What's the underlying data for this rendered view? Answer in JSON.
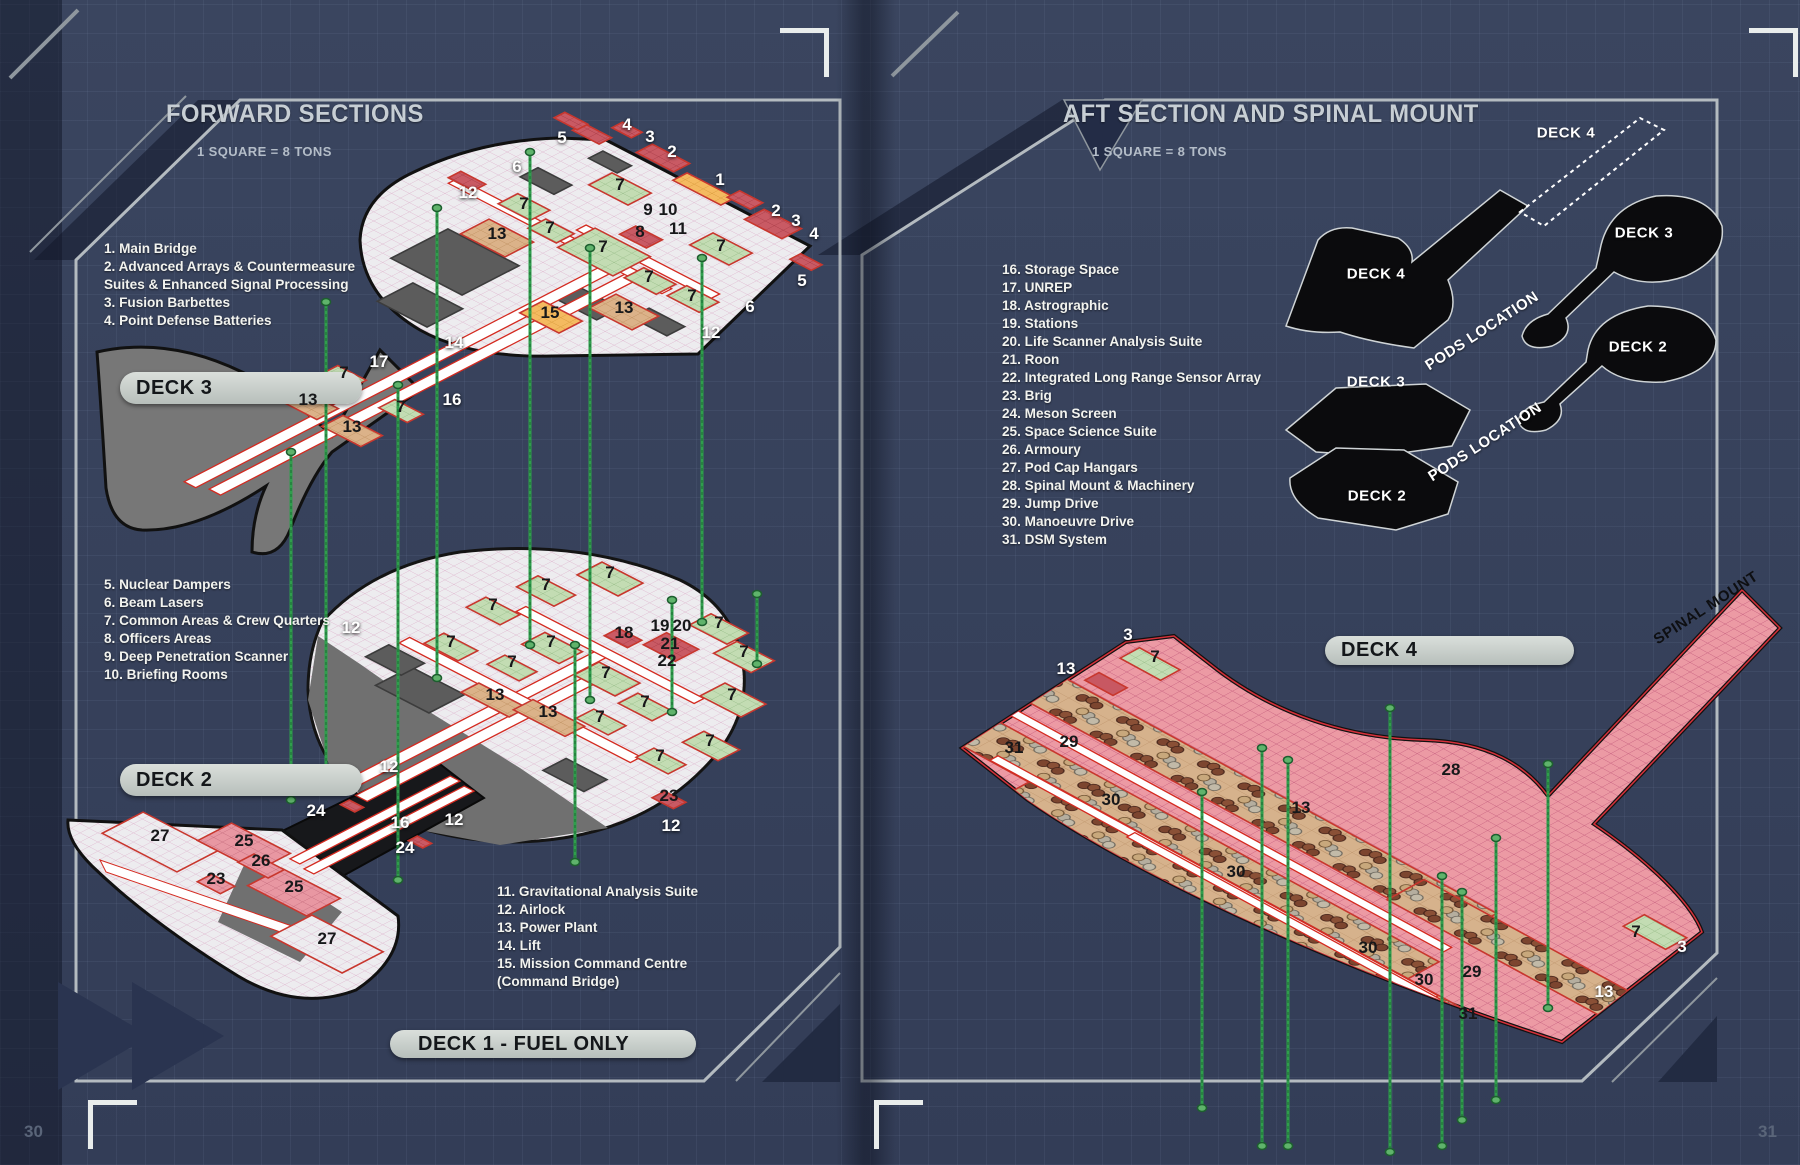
{
  "left_page": {
    "page_number": "30",
    "title": "FORWARD SECTIONS",
    "scale_note": "1 SQUARE = 8 TONS",
    "legend_groups": [
      {
        "items": [
          "1. Main Bridge",
          "2. Advanced Arrays & Countermeasure",
          "Suites & Enhanced Signal Processing",
          "3. Fusion Barbettes",
          "4. Point Defense Batteries"
        ]
      },
      {
        "items": [
          "5. Nuclear Dampers",
          "6. Beam Lasers",
          "7. Common Areas & Crew Quarters",
          "8. Officers Areas",
          "9. Deep Penetration Scanner",
          "10. Briefing Rooms"
        ]
      },
      {
        "items": [
          "11. Gravitational Analysis Suite",
          "12. Airlock",
          "13. Power Plant",
          "14. Lift",
          "15. Mission Command Centre",
          "(Command Bridge)"
        ]
      }
    ],
    "banners": {
      "deck3": "DECK 3",
      "deck2": "DECK 2",
      "deck1": "DECK 1 - FUEL ONLY"
    },
    "callouts": [
      {
        "t": "4",
        "x": 627,
        "y": 125,
        "c": "w"
      },
      {
        "t": "3",
        "x": 650,
        "y": 137,
        "c": "w"
      },
      {
        "t": "2",
        "x": 672,
        "y": 152,
        "c": "w"
      },
      {
        "t": "5",
        "x": 562,
        "y": 138,
        "c": "w"
      },
      {
        "t": "6",
        "x": 517,
        "y": 167,
        "c": "w"
      },
      {
        "t": "12",
        "x": 468,
        "y": 193,
        "c": "w"
      },
      {
        "t": "1",
        "x": 720,
        "y": 180,
        "c": "w"
      },
      {
        "t": "2",
        "x": 776,
        "y": 211,
        "c": "w"
      },
      {
        "t": "3",
        "x": 796,
        "y": 221,
        "c": "w"
      },
      {
        "t": "4",
        "x": 814,
        "y": 234,
        "c": "w"
      },
      {
        "t": "5",
        "x": 802,
        "y": 281,
        "c": "w"
      },
      {
        "t": "6",
        "x": 750,
        "y": 307,
        "c": "w"
      },
      {
        "t": "12",
        "x": 711,
        "y": 333,
        "c": "w"
      },
      {
        "t": "14",
        "x": 454,
        "y": 343,
        "c": "w"
      },
      {
        "t": "17",
        "x": 379,
        "y": 362,
        "c": "w"
      },
      {
        "t": "16",
        "x": 452,
        "y": 400,
        "c": "w"
      },
      {
        "t": "7",
        "x": 620,
        "y": 185,
        "c": "b"
      },
      {
        "t": "9",
        "x": 648,
        "y": 210,
        "c": "b"
      },
      {
        "t": "10",
        "x": 668,
        "y": 210,
        "c": "b"
      },
      {
        "t": "8",
        "x": 640,
        "y": 232,
        "c": "b"
      },
      {
        "t": "11",
        "x": 678,
        "y": 229,
        "c": "b"
      },
      {
        "t": "7",
        "x": 524,
        "y": 204,
        "c": "b"
      },
      {
        "t": "13",
        "x": 497,
        "y": 234,
        "c": "b"
      },
      {
        "t": "7",
        "x": 550,
        "y": 228,
        "c": "b"
      },
      {
        "t": "7",
        "x": 603,
        "y": 247,
        "c": "b"
      },
      {
        "t": "7",
        "x": 721,
        "y": 246,
        "c": "b"
      },
      {
        "t": "7",
        "x": 649,
        "y": 277,
        "c": "b"
      },
      {
        "t": "7",
        "x": 692,
        "y": 296,
        "c": "b"
      },
      {
        "t": "15",
        "x": 550,
        "y": 313,
        "c": "b"
      },
      {
        "t": "13",
        "x": 624,
        "y": 308,
        "c": "b"
      },
      {
        "t": "13",
        "x": 308,
        "y": 400,
        "c": "b"
      },
      {
        "t": "13",
        "x": 352,
        "y": 427,
        "c": "b"
      },
      {
        "t": "7",
        "x": 344,
        "y": 373,
        "c": "b"
      },
      {
        "t": "7",
        "x": 401,
        "y": 407,
        "c": "b"
      },
      {
        "t": "12",
        "x": 351,
        "y": 628,
        "c": "w"
      },
      {
        "t": "12",
        "x": 389,
        "y": 767,
        "c": "w"
      },
      {
        "t": "12",
        "x": 454,
        "y": 820,
        "c": "w"
      },
      {
        "t": "12",
        "x": 671,
        "y": 826,
        "c": "w"
      },
      {
        "t": "16",
        "x": 400,
        "y": 823,
        "c": "w"
      },
      {
        "t": "24",
        "x": 316,
        "y": 811,
        "c": "w"
      },
      {
        "t": "24",
        "x": 405,
        "y": 848,
        "c": "w"
      },
      {
        "t": "7",
        "x": 610,
        "y": 573,
        "c": "b"
      },
      {
        "t": "7",
        "x": 546,
        "y": 585,
        "c": "b"
      },
      {
        "t": "7",
        "x": 493,
        "y": 605,
        "c": "b"
      },
      {
        "t": "7",
        "x": 451,
        "y": 642,
        "c": "b"
      },
      {
        "t": "7",
        "x": 551,
        "y": 642,
        "c": "b"
      },
      {
        "t": "18",
        "x": 624,
        "y": 633,
        "c": "b"
      },
      {
        "t": "19",
        "x": 660,
        "y": 626,
        "c": "b"
      },
      {
        "t": "20",
        "x": 682,
        "y": 626,
        "c": "b"
      },
      {
        "t": "21",
        "x": 670,
        "y": 644,
        "c": "b"
      },
      {
        "t": "22",
        "x": 667,
        "y": 661,
        "c": "b"
      },
      {
        "t": "7",
        "x": 719,
        "y": 623,
        "c": "b"
      },
      {
        "t": "7",
        "x": 744,
        "y": 652,
        "c": "b"
      },
      {
        "t": "7",
        "x": 512,
        "y": 662,
        "c": "b"
      },
      {
        "t": "7",
        "x": 606,
        "y": 673,
        "c": "b"
      },
      {
        "t": "13",
        "x": 495,
        "y": 695,
        "c": "b"
      },
      {
        "t": "13",
        "x": 548,
        "y": 712,
        "c": "b"
      },
      {
        "t": "7",
        "x": 645,
        "y": 702,
        "c": "b"
      },
      {
        "t": "7",
        "x": 732,
        "y": 695,
        "c": "b"
      },
      {
        "t": "7",
        "x": 600,
        "y": 717,
        "c": "b"
      },
      {
        "t": "7",
        "x": 710,
        "y": 741,
        "c": "b"
      },
      {
        "t": "7",
        "x": 660,
        "y": 756,
        "c": "b"
      },
      {
        "t": "23",
        "x": 669,
        "y": 796,
        "c": "b"
      },
      {
        "t": "27",
        "x": 160,
        "y": 836,
        "c": "b"
      },
      {
        "t": "25",
        "x": 244,
        "y": 841,
        "c": "b"
      },
      {
        "t": "26",
        "x": 261,
        "y": 861,
        "c": "b"
      },
      {
        "t": "23",
        "x": 216,
        "y": 879,
        "c": "b"
      },
      {
        "t": "25",
        "x": 294,
        "y": 887,
        "c": "b"
      },
      {
        "t": "27",
        "x": 327,
        "y": 939,
        "c": "b"
      }
    ]
  },
  "right_page": {
    "page_number": "31",
    "title": "AFT SECTION AND SPINAL MOUNT",
    "scale_note": "1 SQUARE = 8 TONS",
    "legend_groups": [
      {
        "items": [
          "16. Storage Space",
          "17. UNREP",
          "18. Astrographic",
          "19. Stations",
          "20. Life Scanner Analysis Suite",
          "21. Roon",
          "22. Integrated Long Range Sensor Array",
          "23. Brig",
          "24. Meson Screen",
          "25. Space Science Suite",
          "26. Armoury",
          "27. Pod Cap Hangars",
          "28. Spinal Mount & Machinery",
          "29. Jump Drive",
          "30. Manoeuvre Drive",
          "31. DSM System"
        ]
      }
    ],
    "banner_deck4": "DECK 4",
    "silhouettes": [
      {
        "label": "DECK 4"
      },
      {
        "label": "DECK 3"
      },
      {
        "label": "DECK 4"
      },
      {
        "label": "DECK 2"
      },
      {
        "label": "DECK 3"
      },
      {
        "label": "DECK 2"
      }
    ],
    "pods_location_labels": [
      "PODS LOCATION",
      "PODS LOCATION"
    ],
    "spinal_mount_label": "SPINAL MOUNT",
    "callouts": [
      {
        "t": "3",
        "x": 1128,
        "y": 635,
        "c": "w"
      },
      {
        "t": "13",
        "x": 1066,
        "y": 669,
        "c": "w"
      },
      {
        "t": "3",
        "x": 1682,
        "y": 947,
        "c": "w"
      },
      {
        "t": "13",
        "x": 1604,
        "y": 992,
        "c": "w"
      },
      {
        "t": "7",
        "x": 1155,
        "y": 657,
        "c": "b"
      },
      {
        "t": "31",
        "x": 1014,
        "y": 748,
        "c": "b"
      },
      {
        "t": "29",
        "x": 1069,
        "y": 742,
        "c": "b"
      },
      {
        "t": "30",
        "x": 1111,
        "y": 800,
        "c": "b"
      },
      {
        "t": "13",
        "x": 1301,
        "y": 808,
        "c": "b"
      },
      {
        "t": "28",
        "x": 1451,
        "y": 770,
        "c": "b"
      },
      {
        "t": "30",
        "x": 1236,
        "y": 872,
        "c": "b"
      },
      {
        "t": "30",
        "x": 1368,
        "y": 948,
        "c": "b"
      },
      {
        "t": "30",
        "x": 1424,
        "y": 980,
        "c": "b"
      },
      {
        "t": "29",
        "x": 1472,
        "y": 972,
        "c": "b"
      },
      {
        "t": "31",
        "x": 1468,
        "y": 1014,
        "c": "b"
      },
      {
        "t": "7",
        "x": 1636,
        "y": 932,
        "c": "b"
      }
    ]
  },
  "colors": {
    "accent_red": "#d42a20",
    "lift_green": "#2f9e4c",
    "pill_gray": "#c9cfcc",
    "deck_pink": "#ec9aa4",
    "blueprint_navy": "#38425c"
  }
}
